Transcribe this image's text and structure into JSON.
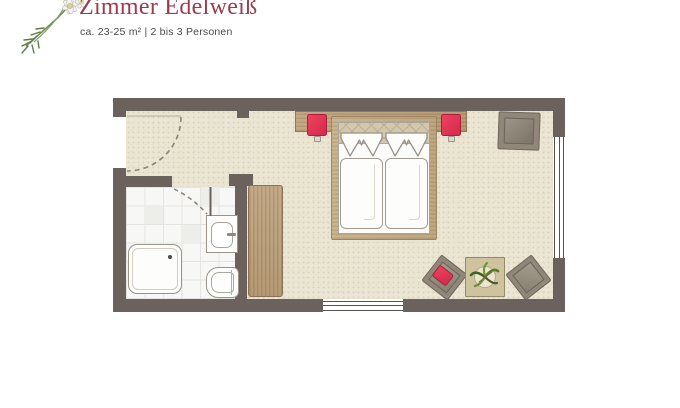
{
  "header": {
    "title": "Zimmer Edelweiß",
    "subtitle": "ca. 23-25 m² | 2 bis 3 Personen",
    "logo_name": "edelweiss-flower-illustration"
  },
  "colors": {
    "title": "#9d3a4e",
    "subtitle": "#4a4a4a",
    "wall": "#6b615d",
    "carpet": "#ebe5d4",
    "tile": "#f7f7f5",
    "wood": "#b89c77",
    "accent_red": "#e23453",
    "chair_gray": "#90877a",
    "table_tan": "#cec29f",
    "linen_white": "#fbfbfa",
    "outline": "#98948a",
    "dash": "#8d8376"
  },
  "floorplan": {
    "view": "top-down architectural plan",
    "rooms": [
      {
        "name": "bedroom",
        "floor": "carpet"
      },
      {
        "name": "bathroom",
        "floor": "white tile"
      },
      {
        "name": "entry",
        "floor": "carpet"
      }
    ],
    "furniture": [
      "double-bed with two duvets and crown-folded pillows",
      "wood headboard panel",
      "red nightstand left",
      "red nightstand right",
      "wardrobe",
      "armchair top right",
      "lounge chair with red cushion",
      "lounge chair right",
      "side table with potted plant",
      "shower",
      "washbasin",
      "toilet"
    ],
    "openings": [
      "entrance door (left wall, dashed swing arc)",
      "bathroom door (dashed swing arc)",
      "window right wall",
      "window bottom wall"
    ]
  }
}
